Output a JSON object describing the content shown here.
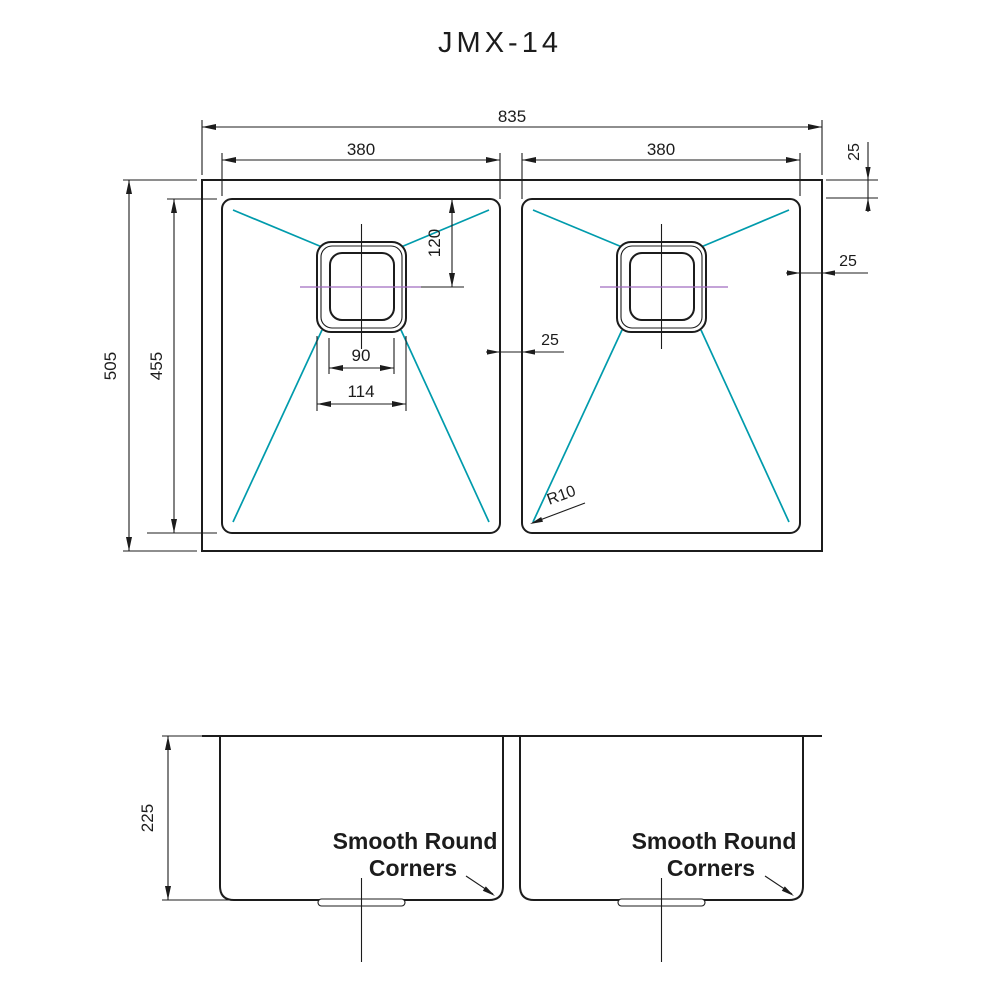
{
  "title": "JMX-14",
  "colors": {
    "outline": "#1c1c1c",
    "slope_line": "#009bac",
    "centerline": "#a06cc0"
  },
  "top_view": {
    "overall_width": "835",
    "left_bowl_width": "380",
    "right_bowl_width": "380",
    "overall_depth": "505",
    "bowl_depth": "455",
    "drain_center_from_top": "120",
    "drain_inner_width": "90",
    "drain_outer_width": "114",
    "divider_width": "25",
    "right_rim": "25",
    "top_rim": "25",
    "corner_radius": "R10"
  },
  "front_view": {
    "bowl_depth": "225",
    "left_note": {
      "line1": "Smooth Round",
      "line2": "Corners"
    },
    "right_note": {
      "line1": "Smooth Round",
      "line2": "Corners"
    }
  }
}
